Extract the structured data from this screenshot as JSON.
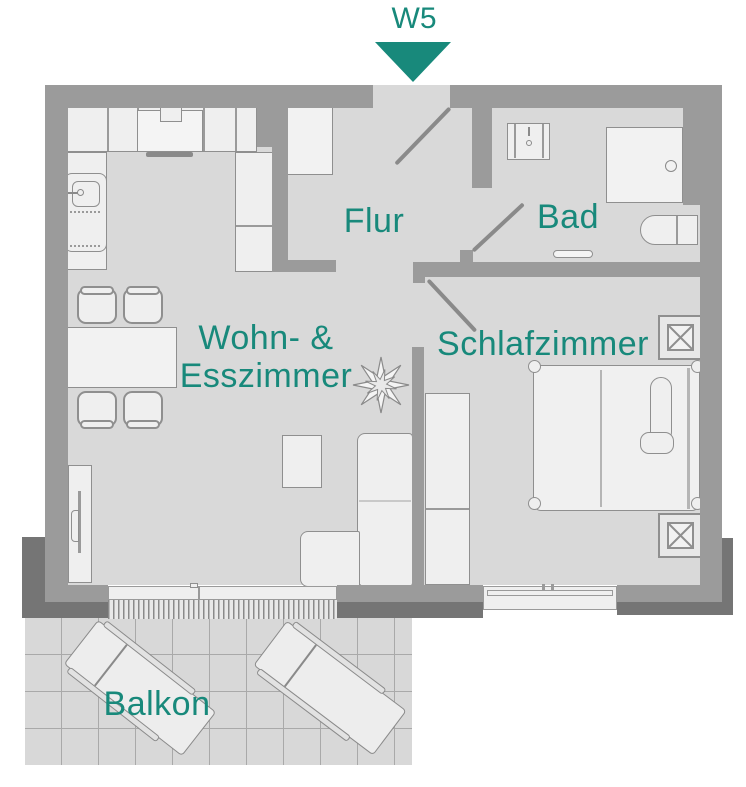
{
  "unit": {
    "label": "W5"
  },
  "rooms": {
    "flur": "Flur",
    "bad": "Bad",
    "wohn_line1": "Wohn- &",
    "wohn_line2": "Esszimmer",
    "schlafzimmer": "Schlafzimmer",
    "balkon": "Balkon"
  },
  "colors": {
    "accent_teal": "#18897b",
    "wall": "#9b9b9b",
    "wall_shadow": "#757575",
    "floor": "#d9d9d9",
    "furniture": "#efefef",
    "outline": "#8f8f8f",
    "balcony_tile": "#d8d8d8"
  }
}
